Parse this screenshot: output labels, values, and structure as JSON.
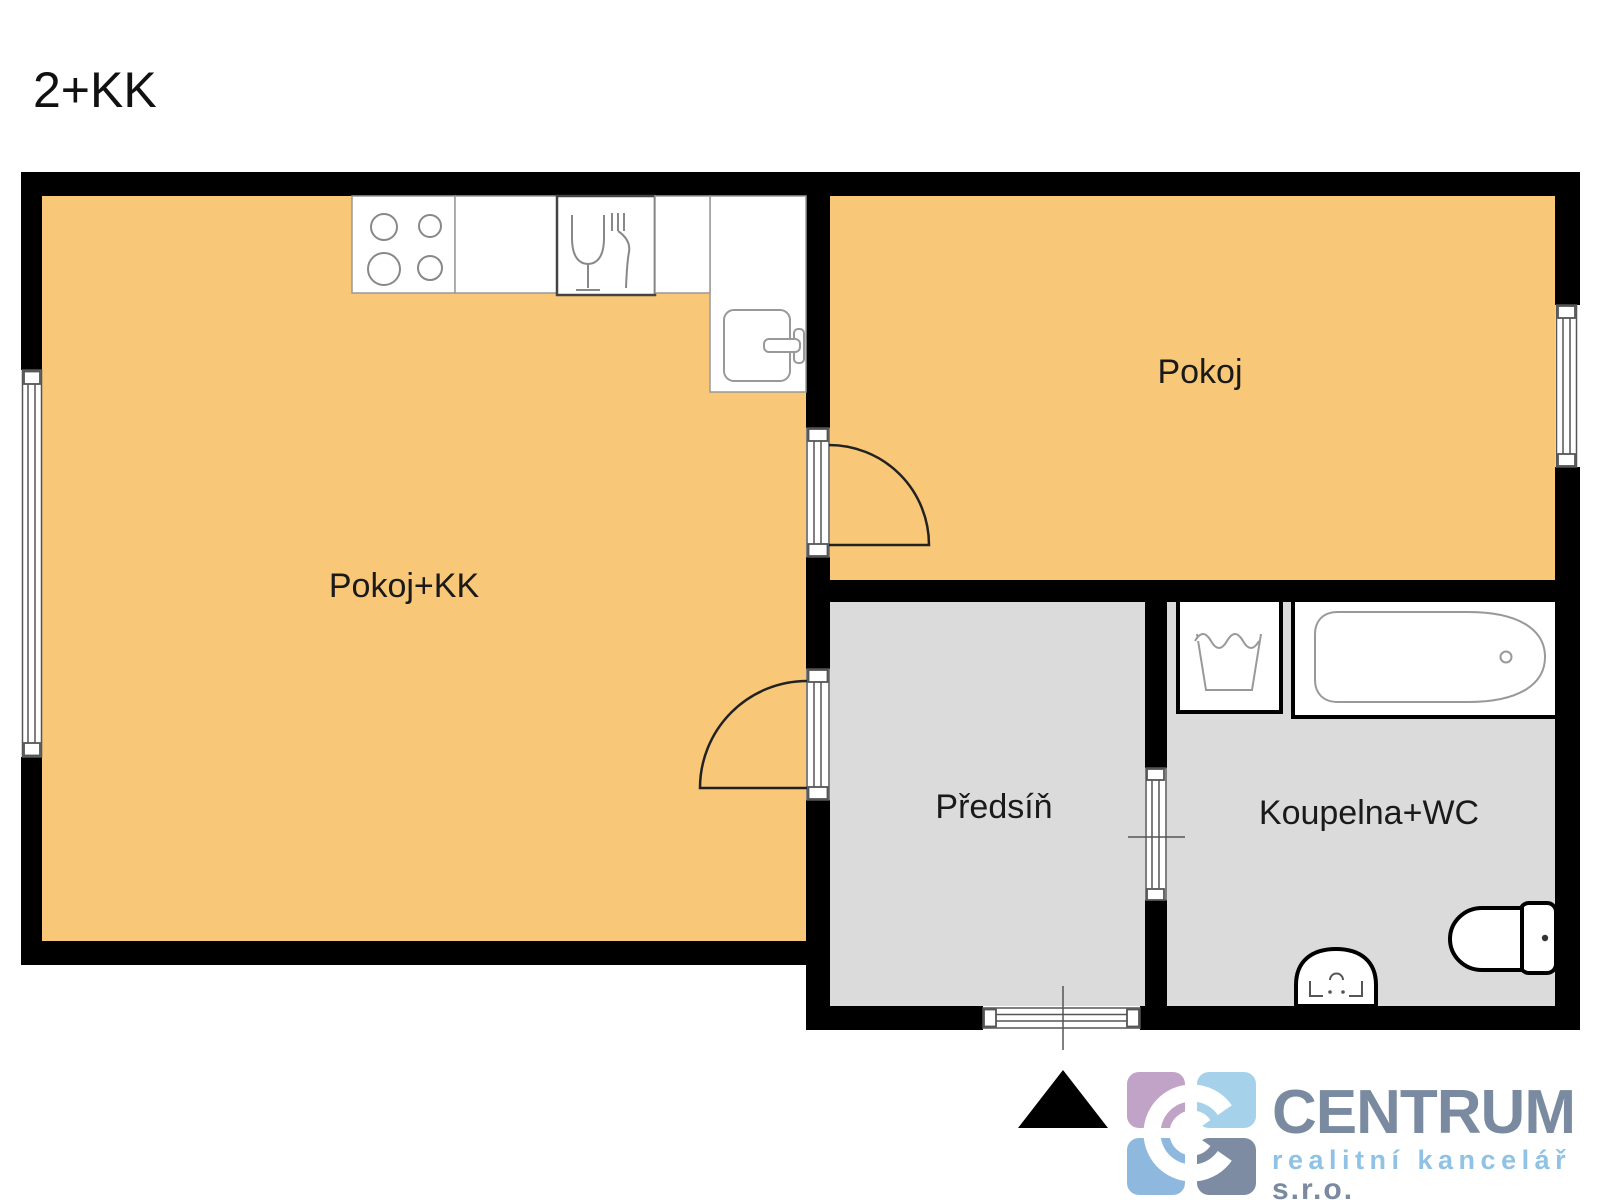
{
  "title": "2+KK",
  "rooms": {
    "living_kitchen": {
      "label": "Pokoj+KK"
    },
    "bedroom": {
      "label": "Pokoj"
    },
    "hallway": {
      "label": "Předsíň"
    },
    "bathroom": {
      "label": "Koupelna+WC"
    }
  },
  "logo": {
    "brand": "CENTRUM",
    "tagline": "realitní kancelář",
    "legal_form": "s.r.o."
  },
  "icons": {
    "stove": "stove-icon",
    "dishwasher": "dishwasher-icon",
    "kitchen_sink": "kitchen-sink-icon",
    "washing_machine": "washing-machine-icon",
    "bathtub": "bathtub-icon",
    "washbasin": "washbasin-icon",
    "toilet": "toilet-icon",
    "entrance_arrow": "entrance-arrow-icon"
  },
  "colors": {
    "room_fill": "#F8C778",
    "wet_room_fill": "#DBDBDB",
    "wall": "#000000",
    "label_text": "#1a1a1a",
    "logo_mauve": "#C1A3C8",
    "logo_light_blue": "#A5D2EA",
    "logo_blue": "#8FB8DE",
    "logo_slate": "#7D8CA3",
    "logo_text": "#7A8AA0",
    "logo_tagline": "#8FC2E4"
  }
}
